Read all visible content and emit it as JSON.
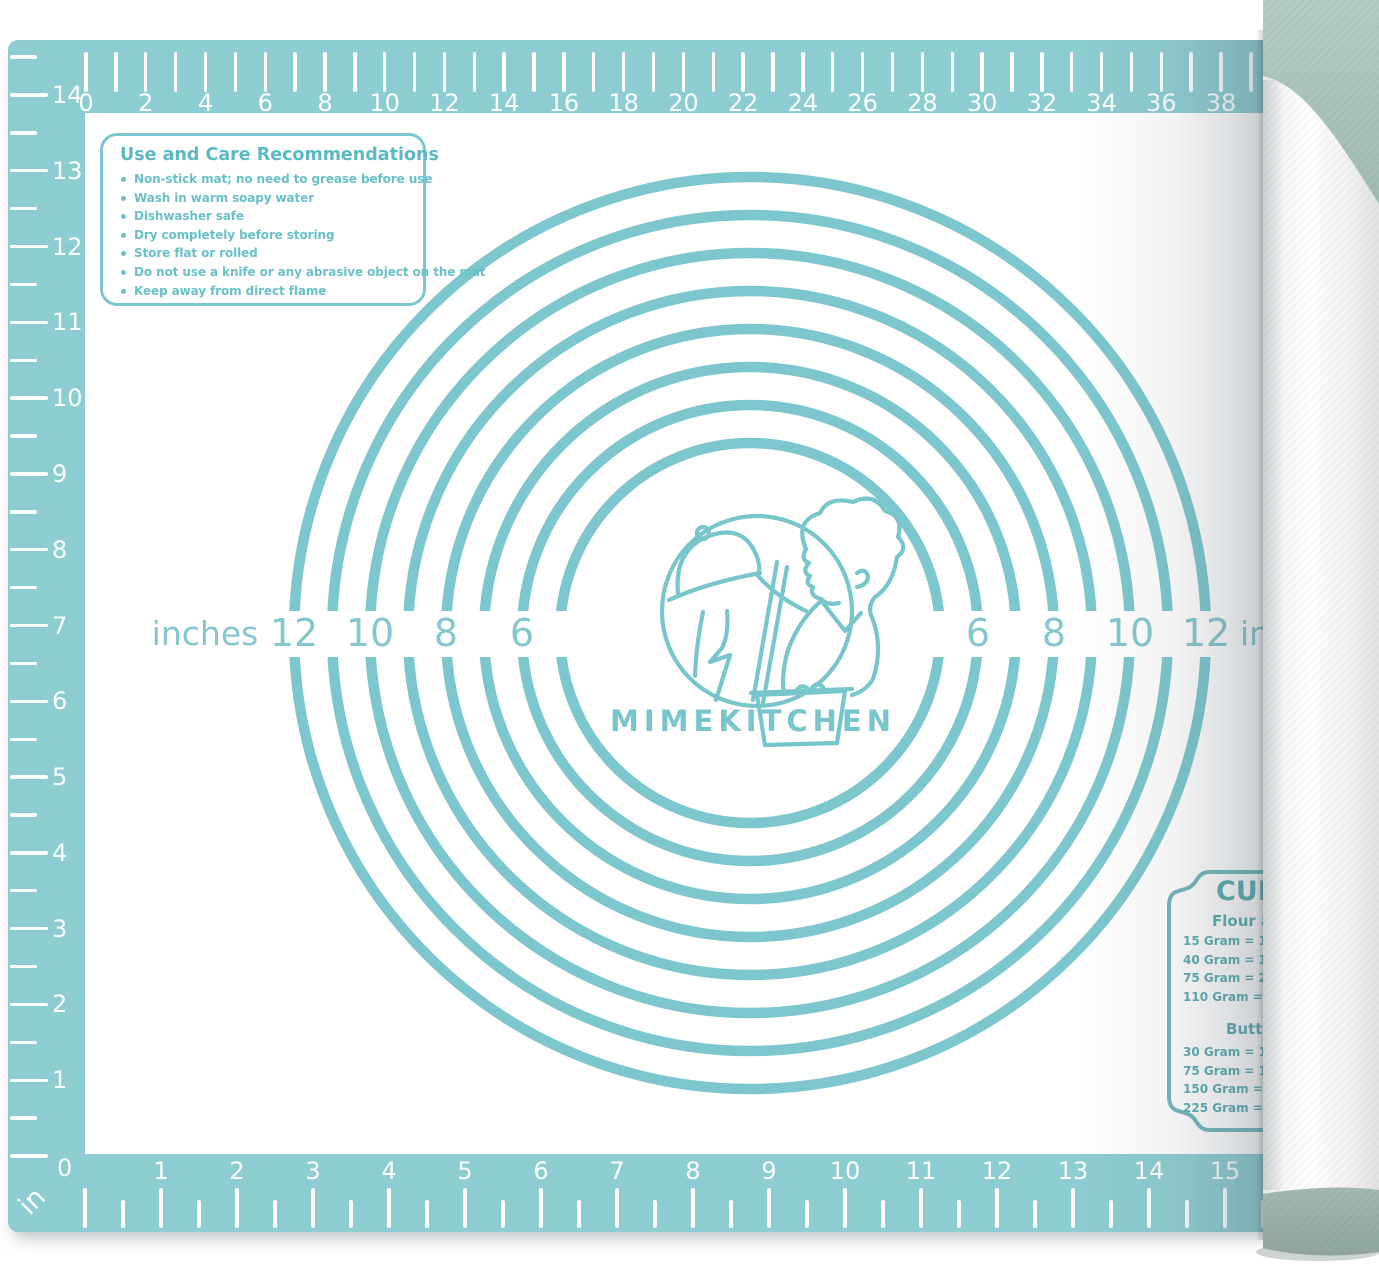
{
  "colors": {
    "mat_teal": "#8dccd1",
    "marking_teal": "#7dc6cd",
    "label_teal": "#84c7cd",
    "text_teal": "#5cb9c3",
    "roll_cap_top": "#a8c3bb",
    "roll_cap_bottom": "#97aea7"
  },
  "care_box": {
    "title": "Use and Care Recommendations",
    "items": [
      "Non-stick mat; no need to grease before use",
      "Wash in warm soapy water",
      "Dishwasher safe",
      "Dry completely before storing",
      "Store flat or rolled",
      "Do not use a knife or any abrasive object on the mat",
      "Keep away from direct flame"
    ]
  },
  "rulers": {
    "top_cm": {
      "labels": [
        "0",
        "2",
        "4",
        "6",
        "8",
        "10",
        "12",
        "14",
        "16",
        "18",
        "20",
        "22",
        "24",
        "26",
        "28",
        "30",
        "32",
        "34",
        "36",
        "38"
      ]
    },
    "left_in": {
      "labels": [
        "14",
        "13",
        "12",
        "11",
        "10",
        "9",
        "8",
        "7",
        "6",
        "5",
        "4",
        "3",
        "2",
        "1"
      ],
      "corner_zero": "0",
      "unit": "in"
    },
    "bottom_in": {
      "labels": [
        "1",
        "2",
        "3",
        "4",
        "5",
        "6",
        "7",
        "8",
        "9",
        "10",
        "11",
        "12",
        "13",
        "14",
        "15"
      ]
    }
  },
  "circle_guide": {
    "unit_word": "inches",
    "diameters_in": [
      5,
      6,
      7,
      8,
      9,
      10,
      11,
      12
    ],
    "left_labels": [
      "12",
      "10",
      "8",
      "6"
    ],
    "right_labels": [
      "6",
      "8",
      "10",
      "12"
    ]
  },
  "logo": {
    "brand": "MIMEKITCHEN"
  },
  "cups_chart": {
    "title": "CUPS",
    "sections": [
      {
        "heading": "Flour and",
        "rows": [
          "15 Gram = 1/8 cup",
          "40 Gram = 1/3 cup",
          "75 Gram = 2/3 cup",
          "110 Gram =  1 cup"
        ]
      },
      {
        "heading": "Butter",
        "rows": [
          "30 Gram = 1/8 cup",
          "75 Gram = 1/3 cup",
          "150 Gram = 2/3 cup",
          "225 Gram =  1 cup"
        ]
      }
    ]
  }
}
